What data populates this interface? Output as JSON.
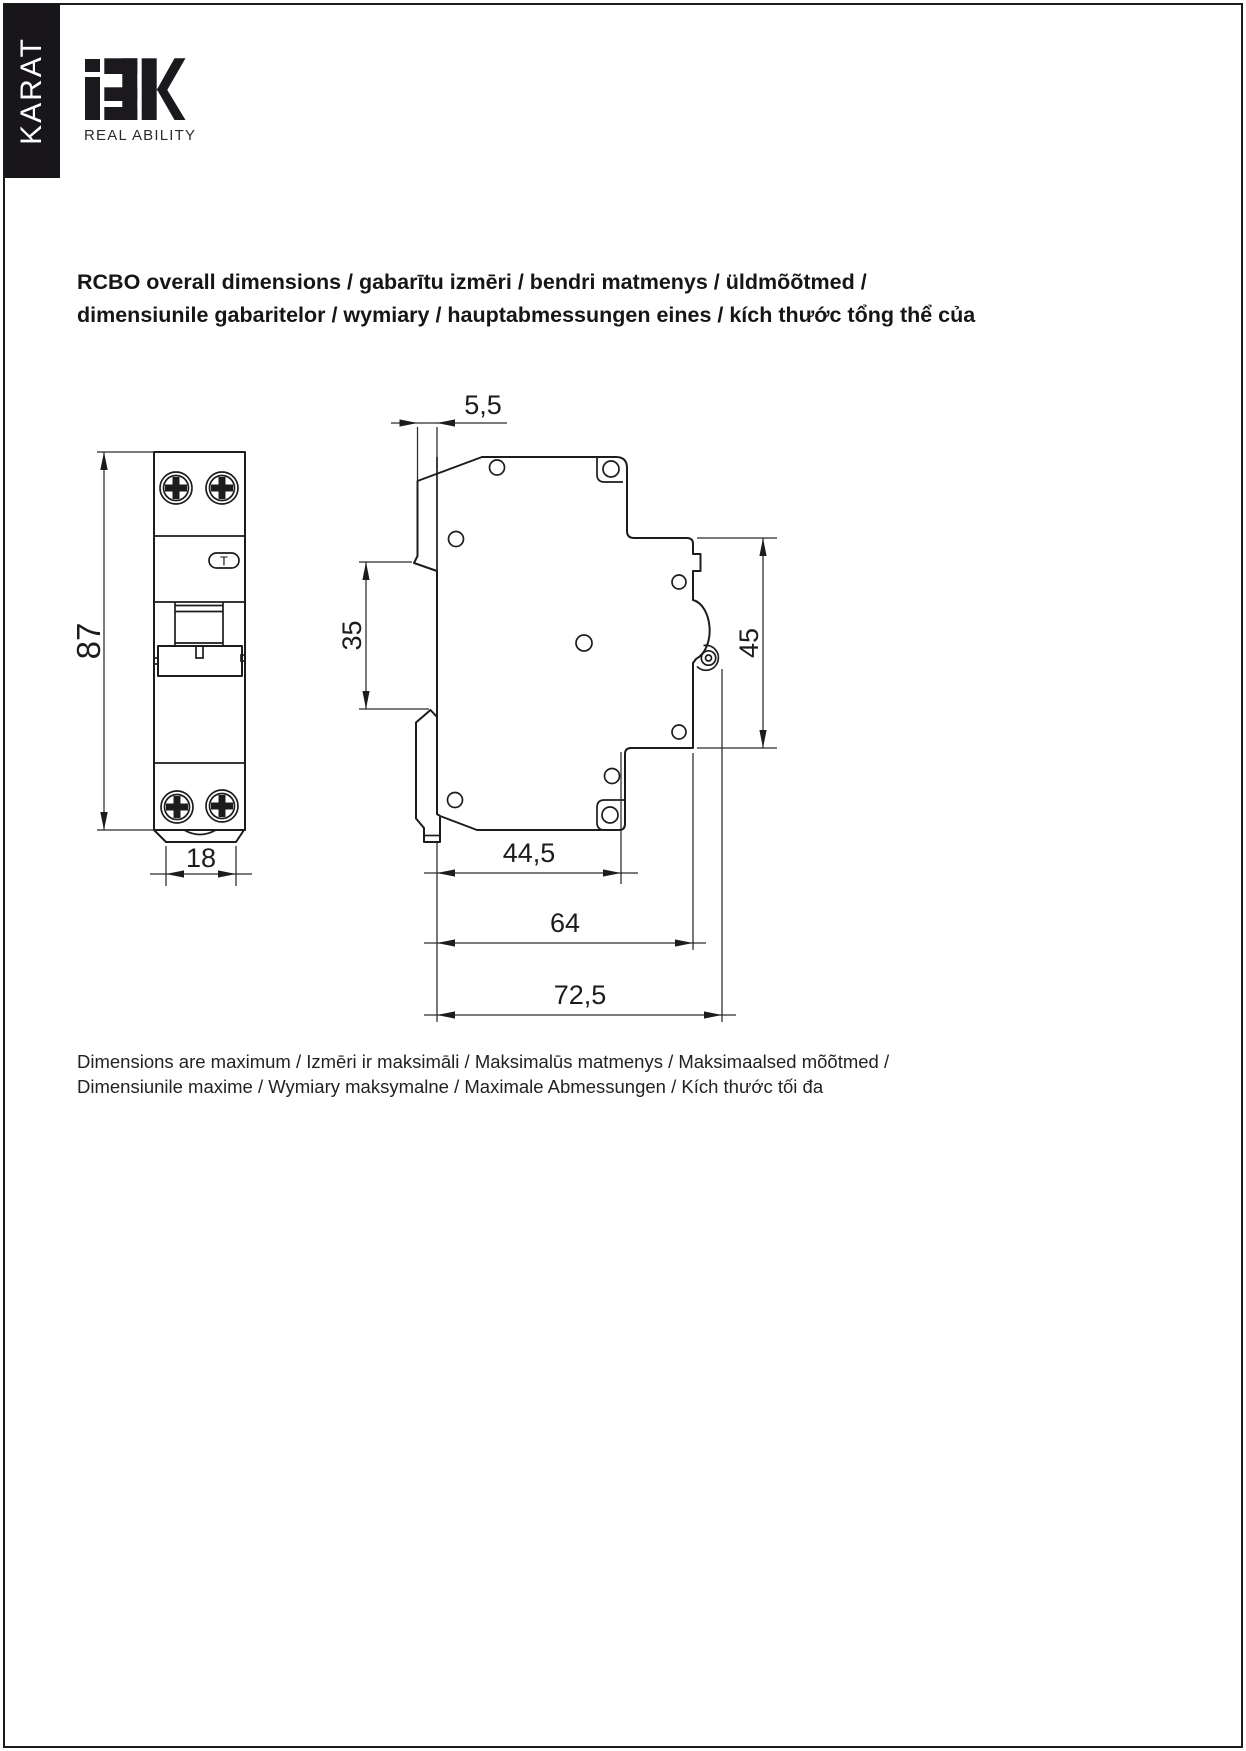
{
  "sidebar": {
    "label": "KARAT"
  },
  "brand": {
    "name": "iEK",
    "tagline": "REAL ABILITY"
  },
  "title": {
    "line1": "RCBO overall dimensions / gabarītu izmēri / bendri matmenys / üldmõõtmed /",
    "line2": "dimensiunile gabaritelor / wymiary / hauptabmessungen eines / kích thước tổng thể của"
  },
  "note": {
    "line1": "Dimensions are maximum / Izmēri ir maksimāli / Maksimalūs matmenys / Maksimaalsed mõõtmed /",
    "line2": "Dimensiunile maxime / Wymiary maksymalne / Maximale Abmessungen / Kích thước tối đa"
  },
  "drawing": {
    "front_view": {
      "height_mm": "87",
      "width_mm": "18",
      "test_button": "T"
    },
    "side_view": {
      "front_offset_mm": "5,5",
      "rail_channel_mm": "35",
      "right_face_mm": "45",
      "depth_step_mm": "44,5",
      "depth_body_mm": "64",
      "depth_overall_mm": "72,5"
    }
  },
  "colors": {
    "ink": "#1c1c1c",
    "paper": "#ffffff",
    "sidebar_bg": "#18161a"
  }
}
